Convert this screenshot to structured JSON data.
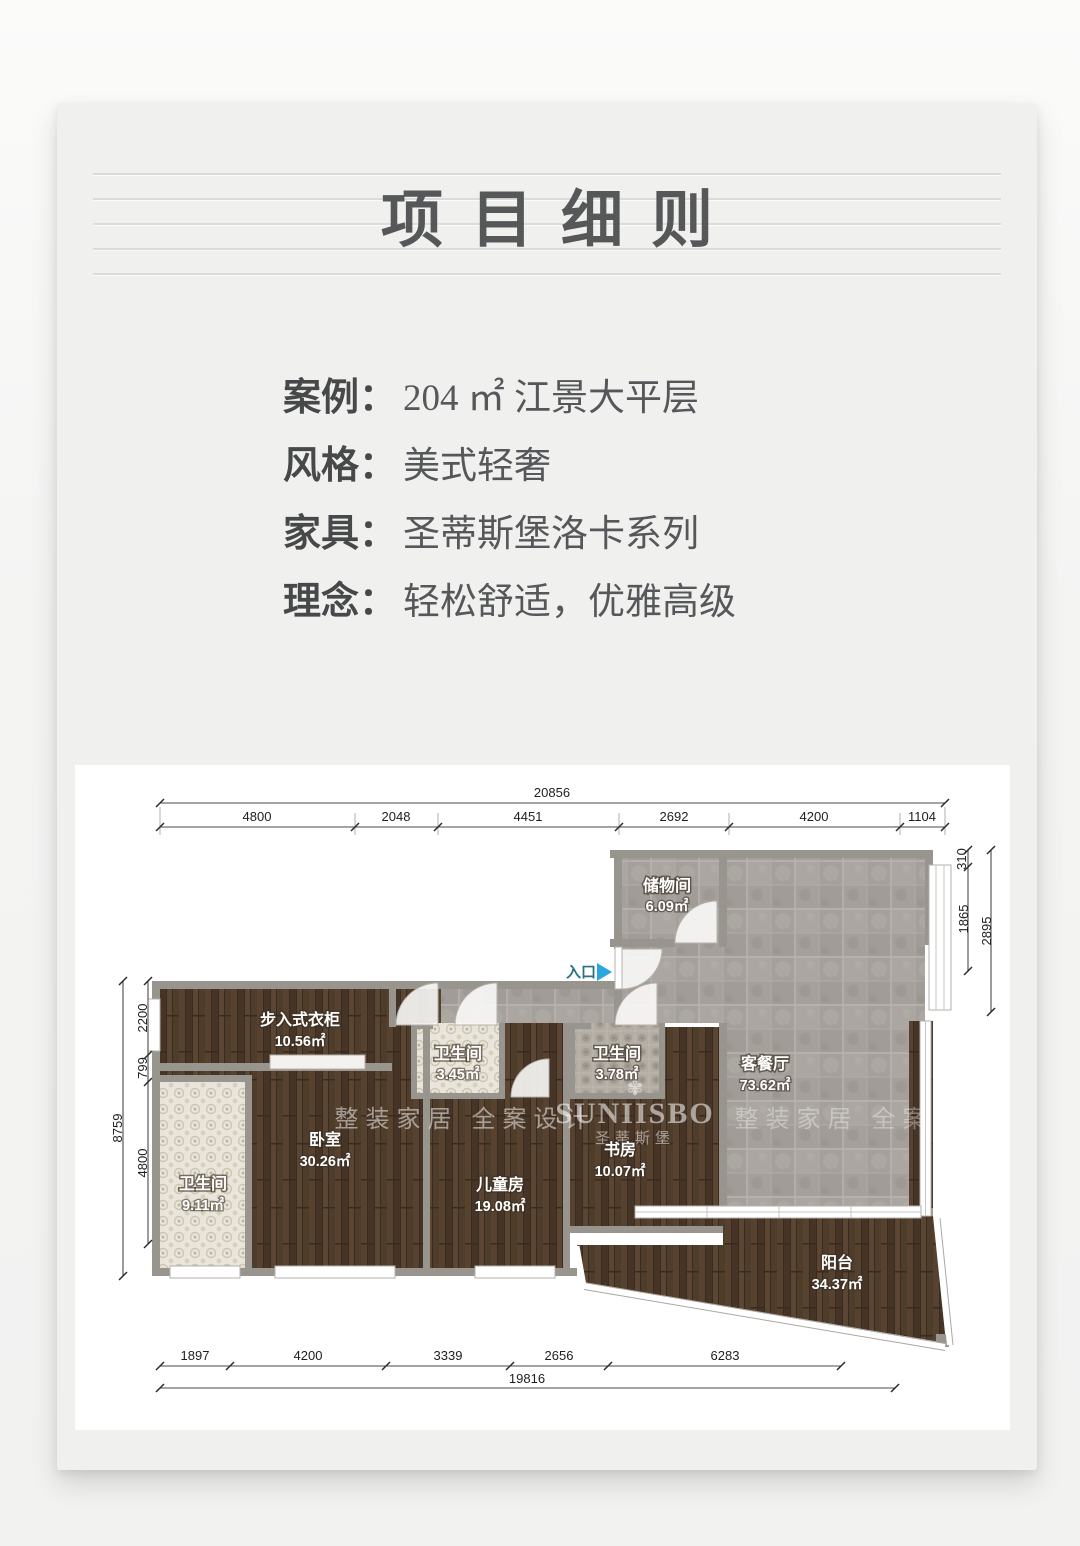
{
  "header": {
    "title": "项目细则"
  },
  "info": {
    "rows": [
      {
        "label": "案例：",
        "value": "204 ㎡ 江景大平层"
      },
      {
        "label": "风格：",
        "value": "美式轻奢"
      },
      {
        "label": "家具：",
        "value": "圣蒂斯堡洛卡系列"
      },
      {
        "label": "理念：",
        "value": "轻松舒适，优雅高级"
      }
    ]
  },
  "plan": {
    "entrance_label": "入口",
    "dims": {
      "top_total": "20856",
      "top_segments": [
        "4800",
        "2048",
        "4451",
        "2692",
        "4200",
        "1104"
      ],
      "right_segments": [
        "310",
        "1865"
      ],
      "right_total": "2895",
      "left_segments": [
        "2200",
        "799",
        "4800"
      ],
      "left_total": "8759",
      "bottom_segments": [
        "1897",
        "4200",
        "3339",
        "2656",
        "6283"
      ],
      "bottom_total": "19816"
    },
    "rooms": [
      {
        "name": "储物间",
        "area": "6.09㎡"
      },
      {
        "name": "客餐厅",
        "area": "73.62㎡"
      },
      {
        "name": "步入式衣柜",
        "area": "10.56㎡"
      },
      {
        "name": "卫生间",
        "area": "3.45㎡"
      },
      {
        "name": "卫生间",
        "area": "3.78㎡"
      },
      {
        "name": "卧室",
        "area": "30.26㎡"
      },
      {
        "name": "儿童房",
        "area": "19.08㎡"
      },
      {
        "name": "书房",
        "area": "10.07㎡"
      },
      {
        "name": "卫生间",
        "area": "9.11㎡"
      },
      {
        "name": "阳台",
        "area": "34.37㎡"
      }
    ],
    "watermark": {
      "brand": "SUNIISBO",
      "brand_cn": "圣蒂斯堡",
      "flower": "✾",
      "slogan": "整装家居 全案设计"
    },
    "colors": {
      "accent_blue": "#2aa7df",
      "entrance_text": "#2a7286",
      "wall_gray": "#98948e",
      "wood_brown": "#4c3a2b",
      "tile_gray": "#a5a09b"
    }
  }
}
